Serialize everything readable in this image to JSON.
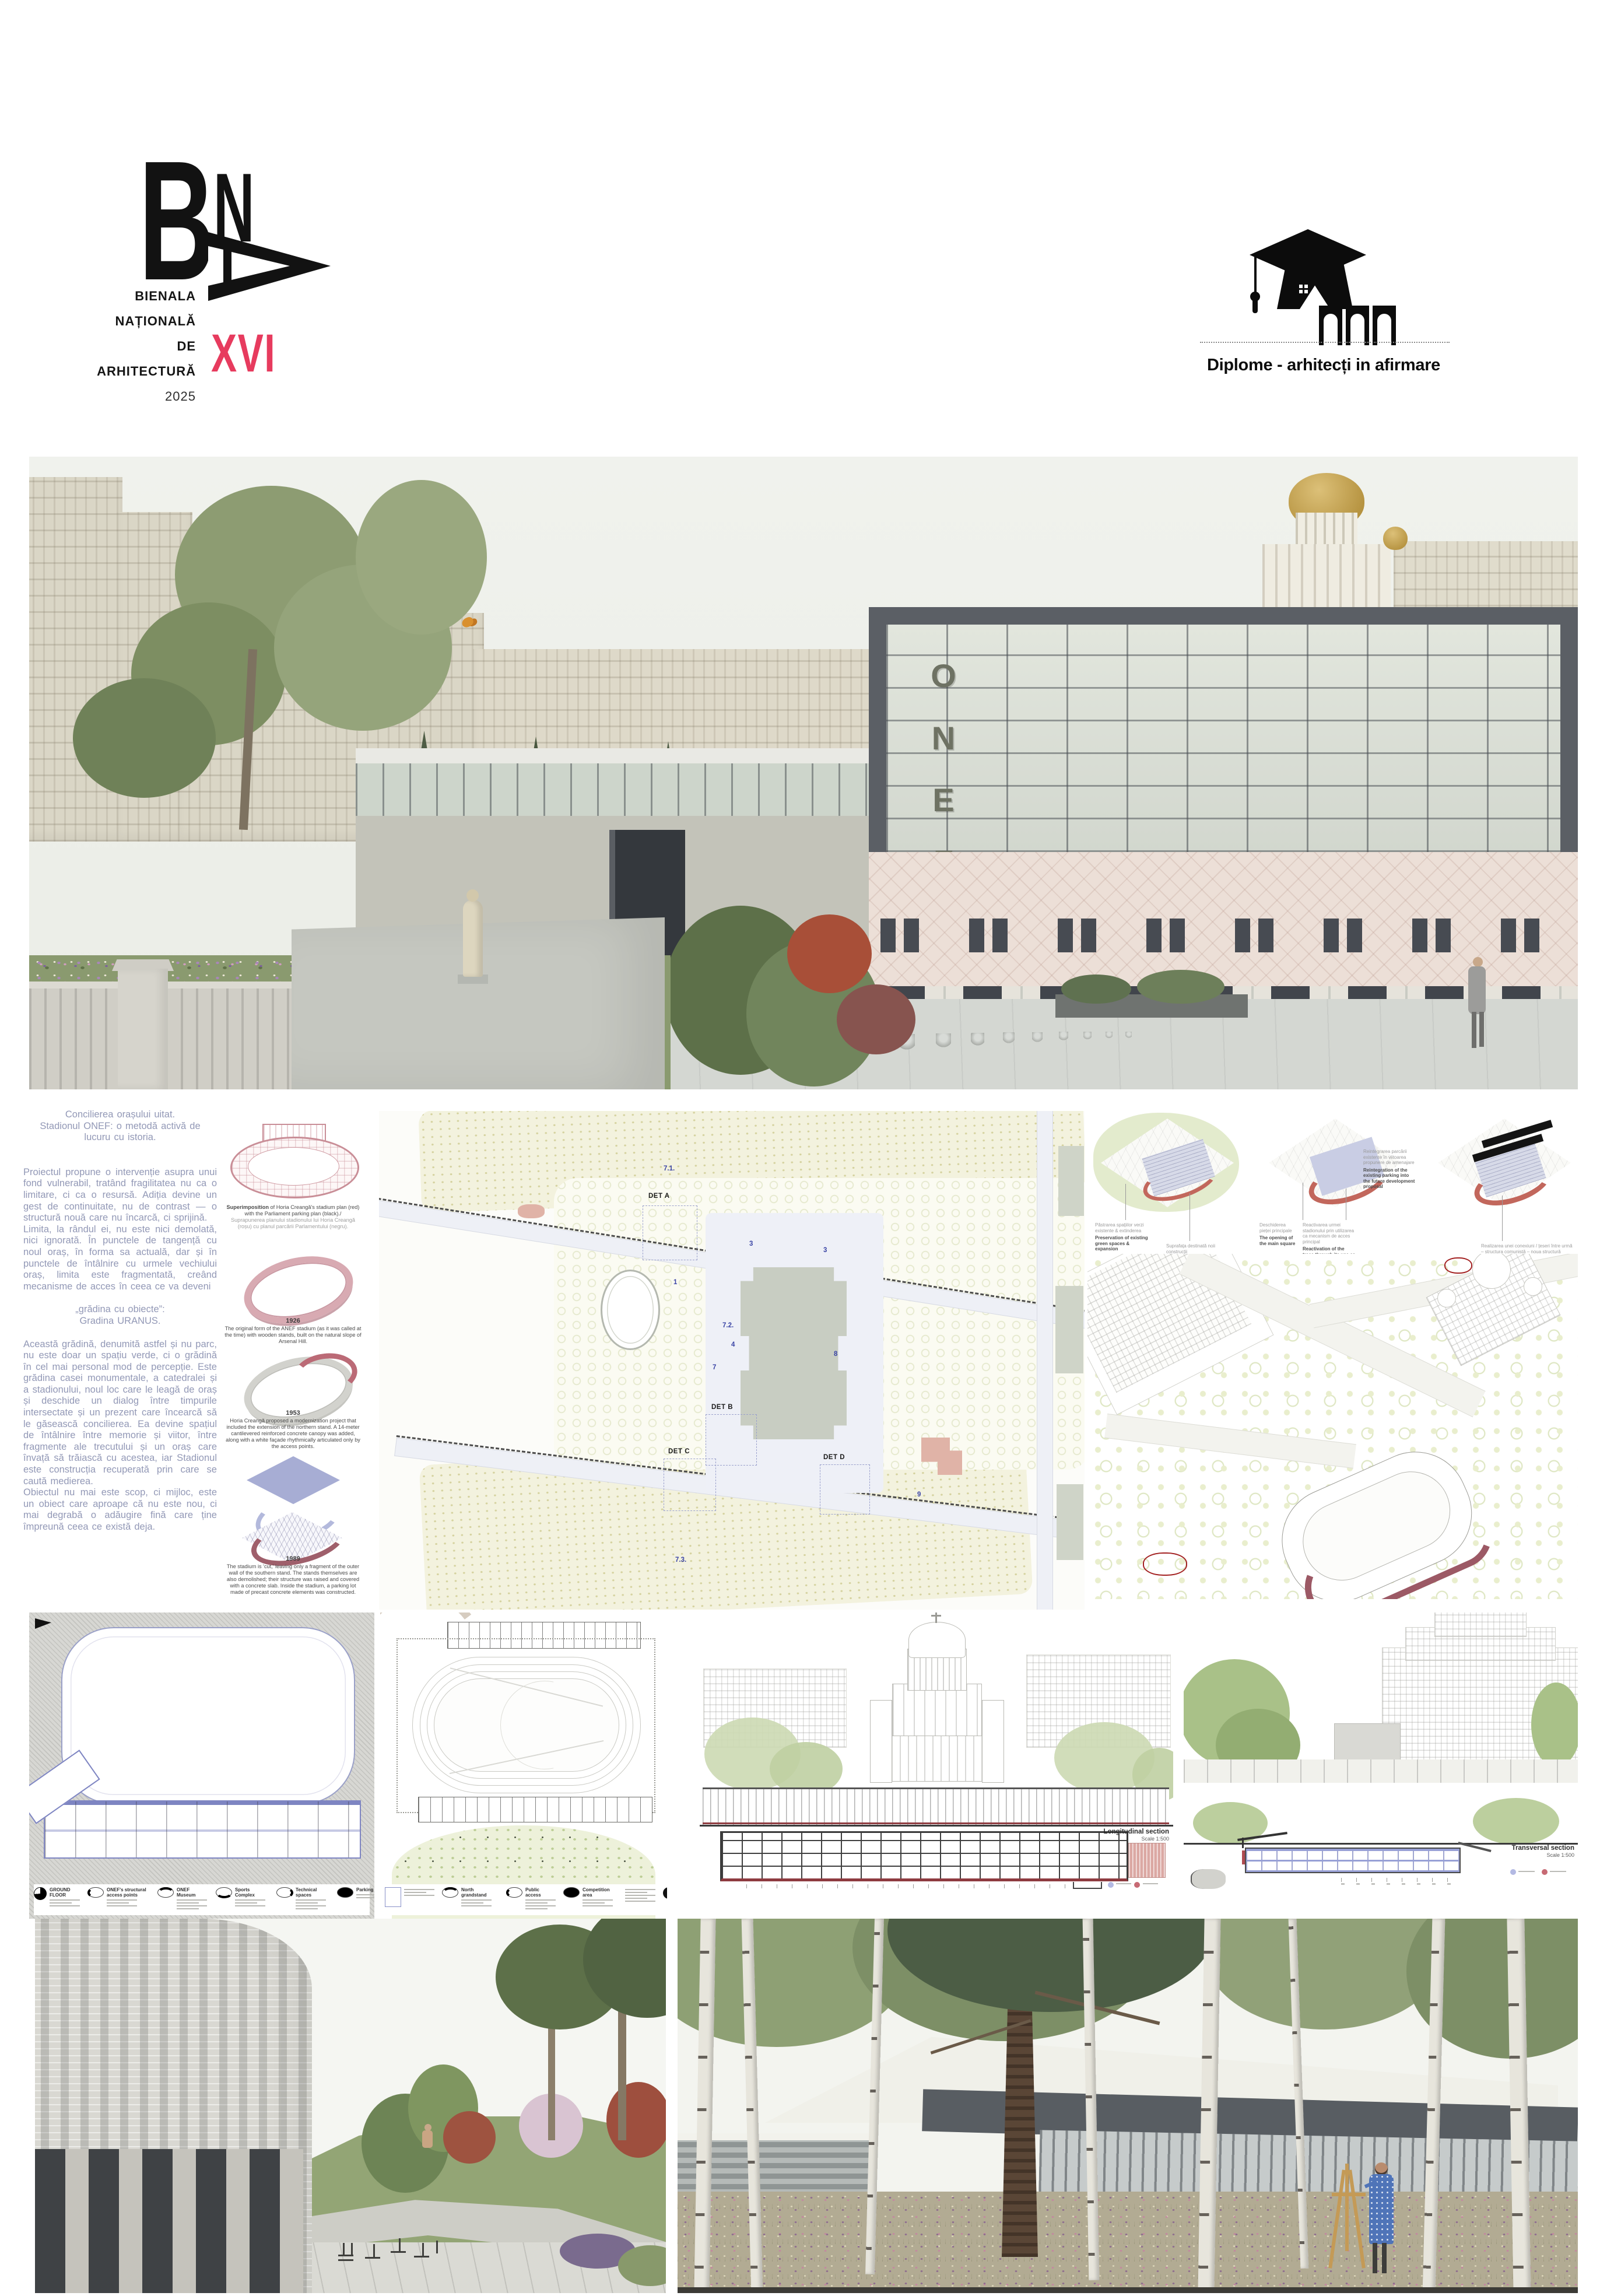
{
  "header": {
    "bna": {
      "letter_b": "B",
      "letter_n": "N",
      "lines": [
        "BIENALA",
        "NAȚIONALĂ",
        "DE",
        "ARHITECTURĂ"
      ],
      "year": "2025",
      "edition": "XVI",
      "accent_color": "#e73b5e"
    },
    "diplome": {
      "label": "Diplome - arhitecți in afirmare"
    }
  },
  "hero": {
    "sign": "ONEF",
    "sign_letters": [
      "O",
      "N",
      "E",
      "F"
    ]
  },
  "article": {
    "title_lines": [
      "Concilierea orașului uitat.",
      "Stadionul ONEF: o metodă activă de",
      "lucuru cu istoria."
    ],
    "p1": "Proiectul propune o intervenție asupra unui fond vulnerabil, tratând fragilitatea nu ca o limitare, ci ca o resursă. Adiția devine un gest de continuitate, nu de contrast — o structură nouă care nu încarcă, ci sprijină.",
    "p2": "Limita, la rândul ei, nu este nici demolată, nici ignorată. În punctele de tangență cu noul oraș, în forma sa actuală, dar și în punctele de întâlnire cu urmele vechiului oraș, limita este fragmentată, creând mecanisme de acces în ceea ce va deveni",
    "quote_lines": [
      "„grădina cu obiecte”:",
      "Gradina URANUS."
    ],
    "p3": "Această grădină, denumită astfel și nu parc, nu este doar un spațiu verde, ci o grădină în cel mai personal mod de percepție. Este grădina casei monumentale, a catedralei și a stadionului, noul loc care le leagă de oraș și deschide un dialog între timpurile intersectate și un prezent care încearcă să le găsească concilierea. Ea devine spațiul de întâlnire între memorie și viitor, între fragmente ale trecutului și un oraș care învață să trăiască cu acestea, iar Stadionul este construcția recuperată prin care se caută medierea.",
    "p4": "Obiectul nu mai este scop, ci mijloc, este un obiect care aproape că nu este nou, ci mai degrabă o adăugire fină care ține împreună ceea ce există deja.",
    "text_color": "#9298b6"
  },
  "timeline": {
    "items": [
      {
        "year": "",
        "en_bold": "Superimposition",
        "en": " of Horia Creangă's stadium plan (red) with the Parliament parking plan (black)./",
        "ro": "Suprapunerea planului stadionului lui Horia Creangă (roșu) cu planul parcării Parlamentului (negru)."
      },
      {
        "year": "1926",
        "en": "The original form of the ANEF stadium (as it was called at the time) with wooden stands, built on the natural slope of Arsenal Hill."
      },
      {
        "year": "1953",
        "en": "Horia Creangă proposed a modernization project that included the extension of the northern stand. A 14-meter cantilevered reinforced concrete canopy was added, along with a white façade rhythmically articulated only by the access points."
      },
      {
        "year": "1989",
        "en": "The stadium is 'cut,' leaving only a fragment of the outer wall of the southern stand. The stands themselves are also demolished; their structure was raised and covered with a concrete slab. Inside the stadium, a parking lot made of precast concrete elements was constructed."
      }
    ]
  },
  "site_plan": {
    "det_labels": [
      "DET A",
      "DET B",
      "DET C",
      "DET D"
    ],
    "numbers": [
      "1",
      "3",
      "3",
      "4",
      "7",
      "8",
      "9",
      "7.1.",
      "7.2.",
      "7.3."
    ]
  },
  "concept": {
    "d1_cap1_ro": "Păstrarea spațiilor verzi existente & extinderea",
    "d1_cap1_en": "Preservation of existing green spaces & expansion",
    "d1_cap2_ro": "Suprafața destinată noii construcții",
    "d1_cap2_en": "The proposed footprint for the building",
    "d2_cap1_ro": "Deschiderea pieței principale",
    "d2_cap1_en": "The opening of the main square",
    "d2_cap2_ro": "Reactivarea urmei stadionului prin utilizarea ca mecanism de acces principal",
    "d2_cap2_en": "Reactivation of the trace through its use as the main access mechanism",
    "d2_cap3_ro": "Reintegrarea parcării existente în viitoarea propunere de amenajare",
    "d2_cap3_en": "Reintegration of the existing parking into the future development proposal",
    "d3_cap1_ro": "Realizarea unei conexiuni / țeseri între urmă – structura comunistă – noua structură",
    "d3_cap1_en": "Creating a connection/weaving between the trace, the communist structure, and the new structure"
  },
  "plans": {
    "ground_floor": {
      "title": "GROUND FLOOR",
      "legend": [
        "ONEF's structural access points",
        "ONEF Museum",
        "Sports Complex",
        "Technical spaces",
        "Parking"
      ]
    },
    "stadium_level": {
      "legend": [
        "North grandstand",
        "Public access",
        "Competition area"
      ]
    }
  },
  "sections": {
    "longitudinal": {
      "title": "Longitudinal section",
      "scale": "Scale 1:500"
    },
    "transversal": {
      "title": "Transversal section",
      "scale": "Scale 1:500"
    }
  }
}
